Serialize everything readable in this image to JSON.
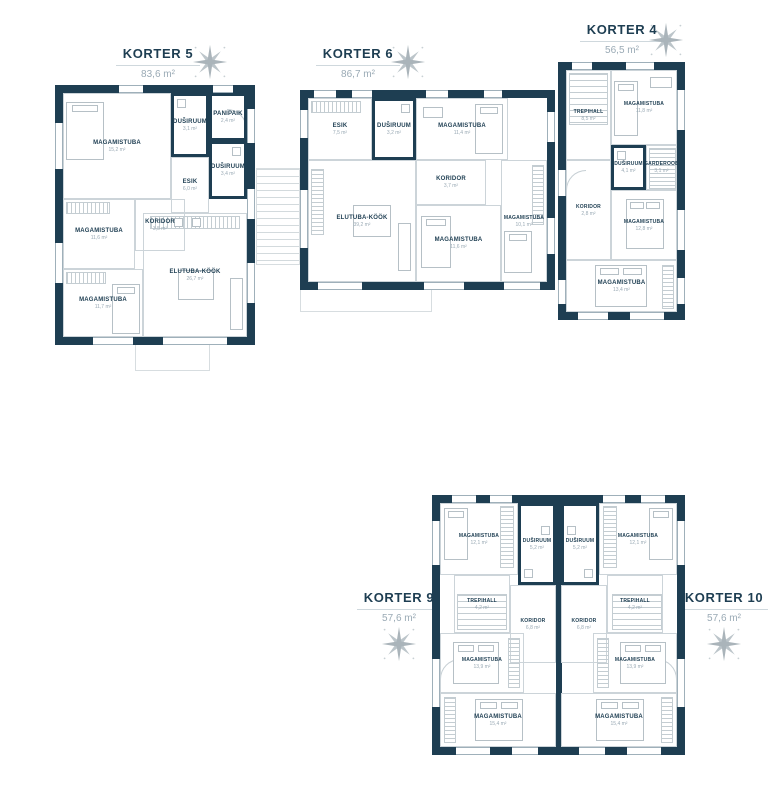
{
  "colors": {
    "wall": "#1e3e52",
    "title_text": "#1e3e52",
    "muted_text": "#9aaab5",
    "line": "#c6cfd4"
  },
  "units": {
    "k5": {
      "title": "KORTER 5",
      "total": "83,6 m²",
      "rooms": [
        {
          "label": "MAGAMISTUBA",
          "area": "15,2 m²"
        },
        {
          "label": "DUŠIRUUM",
          "area": "3,1 m²"
        },
        {
          "label": "PANIPAIK",
          "area": "2,4 m²"
        },
        {
          "label": "DUŠIRUUM",
          "area": "3,4 m²"
        },
        {
          "label": "ESIK",
          "area": "6,0 m²"
        },
        {
          "label": "MAGAMISTUBA",
          "area": "11,6 m²"
        },
        {
          "label": "KORIDOR",
          "area": "3,5 m²"
        },
        {
          "label": "MAGAMISTUBA",
          "area": "11,7 m²"
        },
        {
          "label": "ELUTUBA-KÖÖK",
          "area": "26,7 m²"
        }
      ]
    },
    "k6": {
      "title": "KORTER 6",
      "total": "86,7 m²",
      "rooms": [
        {
          "label": "ESIK",
          "area": "7,5 m²"
        },
        {
          "label": "DUŠIRUUM",
          "area": "3,2 m²"
        },
        {
          "label": "MAGAMISTUBA",
          "area": "11,4 m²"
        },
        {
          "label": "KORIDOR",
          "area": "3,7 m²"
        },
        {
          "label": "ELUTUBA-KÖÖK",
          "area": "39,2 m²"
        },
        {
          "label": "MAGAMISTUBA",
          "area": "11,6 m²"
        },
        {
          "label": "MAGAMISTUBA",
          "area": "10,1 m²"
        }
      ]
    },
    "k4": {
      "title": "KORTER 4",
      "total": "56,5 m²",
      "rooms": [
        {
          "label": "TREPIHALL",
          "area": "8,5 m²"
        },
        {
          "label": "MAGAMISTUBA",
          "area": "11,8 m²"
        },
        {
          "label": "KORIDOR",
          "area": "2,8 m²"
        },
        {
          "label": "DUŠIRUUM",
          "area": "4,1 m²"
        },
        {
          "label": "GARDEROOB",
          "area": "3,1 m²"
        },
        {
          "label": "MAGAMISTUBA",
          "area": "12,8 m²"
        },
        {
          "label": "MAGAMISTUBA",
          "area": "13,4 m²"
        }
      ]
    },
    "k9": {
      "title": "KORTER 9",
      "total": "57,6 m²",
      "rooms": [
        {
          "label": "MAGAMISTUBA",
          "area": "12,1 m²"
        },
        {
          "label": "DUŠIRUUM",
          "area": "5,2 m²"
        },
        {
          "label": "TREPIHALL",
          "area": "4,2 m²"
        },
        {
          "label": "KORIDOR",
          "area": "6,8 m²"
        },
        {
          "label": "MAGAMISTUBA",
          "area": "13,9 m²"
        },
        {
          "label": "MAGAMISTUBA",
          "area": "15,4 m²"
        }
      ]
    },
    "k10": {
      "title": "KORTER 10",
      "total": "57,6 m²",
      "rooms": [
        {
          "label": "MAGAMISTUBA",
          "area": "12,1 m²"
        },
        {
          "label": "DUŠIRUUM",
          "area": "5,2 m²"
        },
        {
          "label": "TREPIHALL",
          "area": "4,2 m²"
        },
        {
          "label": "KORIDOR",
          "area": "6,8 m²"
        },
        {
          "label": "MAGAMISTUBA",
          "area": "13,9 m²"
        },
        {
          "label": "MAGAMISTUBA",
          "area": "15,4 m²"
        }
      ]
    }
  }
}
